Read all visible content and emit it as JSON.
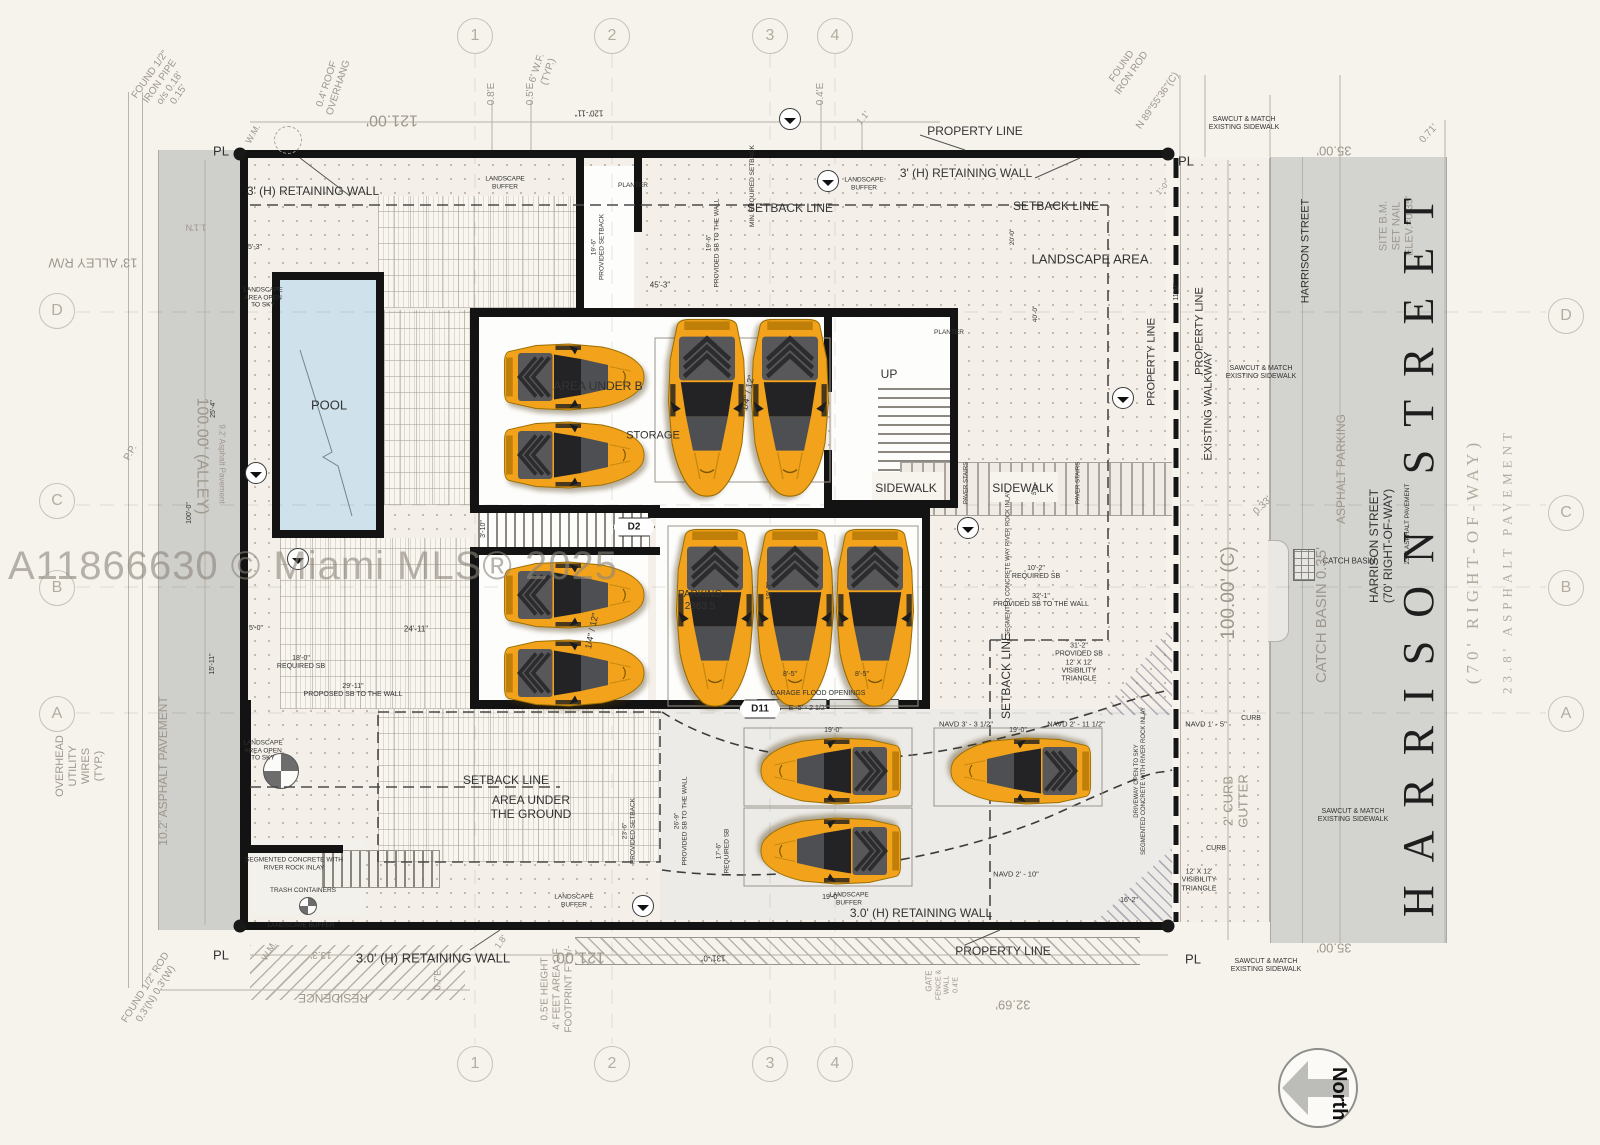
{
  "watermark": "A11866630 © Miami MLS® 2025",
  "compass": {
    "label": "North"
  },
  "grid": {
    "top": [
      "1",
      "2",
      "3",
      "4"
    ],
    "bottom": [
      "1",
      "2",
      "3",
      "4"
    ],
    "left": [
      "D",
      "C",
      "B",
      "A"
    ],
    "right": [
      "D",
      "C",
      "B",
      "A"
    ]
  },
  "tags": {
    "d2": "D2",
    "d11": "D11"
  },
  "cars": {
    "count": 12,
    "body_color": "#f2a31b",
    "accent_color": "#4d4f52"
  },
  "colors": {
    "paper": "#f6f2ec",
    "asphalt": "#d3d3d0",
    "pool_water": "#cfe1ea",
    "wall": "#131313"
  },
  "ann": {
    "found_pipe": "FOUND 1/2\"\nIRON PIPE\no/s 0.18'\n0.15'",
    "wm_tl": "W.M.",
    "roof_ovh": "0.4' ROOF\nOVERHANG",
    "wf_typ": "6' W.F.\n(TYP.)",
    "d121t": "121.00'",
    "d12011": "120'-11\"",
    "e08": "0.8'E",
    "e05": "0.5'E",
    "e04": "0.4'E",
    "d11e": "1.1'",
    "prop_top": "PROPERTY LINE",
    "rod_tr": "FOUND\nIRON ROD",
    "bearing": "N 89°55'36\"(C)",
    "sawcut1": "SAWCUT & MATCH\nEXISTING SIDEWALK",
    "d35t": "35.00'",
    "sitebm": "SITE B.M.\nSET NAIL\nELEV.=0.35'",
    "hsst_top": "HARRISON STREET",
    "d071": "0.71'",
    "pl_tl": "PL",
    "pl_tr": "PL",
    "alley_rw": "13' ALLEY R/W",
    "alley100": "100.00' (ALLEY)",
    "alley_asp": "9.2' Asphalt Pavement",
    "pp": "P.P.",
    "d100ft": "100'-0\"",
    "d1511": "15'-11\"",
    "d254": "25'-4\"",
    "ohw": "OVERHEAD\nUTILITY\nWIRES\n(TYP.)",
    "asp102": "10.2' ASPHALT PAVEMENT",
    "d11n": "1.1'N",
    "d53": "5'-3\"",
    "ret_tl": "3' (H) RETAINING WALL",
    "ret_tr": "3' (H) RETAINING WALL",
    "lb1": "LANDSCAPE\nBUFFER",
    "lb2": "LANDSCAPE\nBUFFER",
    "pltr1": "PLANTER",
    "sbt1": "SETBACK LINE",
    "sbt2": "SETBACK LINE",
    "minreq": "MIN. REQUIRED SETBACK",
    "prov1": "19'-6\"\nPROVIDED SETBACK",
    "prov2": "19'-6\"\nPROVIDED SB TO THE WALL",
    "d453": "45'-3\"",
    "lsarea": "LANDSCAPE AREA",
    "pltr2": "PLANTER",
    "d200": "20'-0\"",
    "d400": "40'-0\"",
    "pl_v1": "PROPERTY LINE",
    "d110": "11'-0\"",
    "d10": "1'-0\"",
    "sawcut2": "SAWCUT & MATCH\nEXISTING SIDEWALK",
    "pl_v2": "PROPERTY LINE",
    "exwalk": "EXISTING WALKWAY",
    "c100": "100.00' (C)",
    "d033": "0.33'",
    "catchb": "CATCH BASIN",
    "catch_big": "CATCH BASIN 0.35'",
    "asparkg": "ASPHALT PARKING",
    "hs_med": "HARRISON STREET\n(70' RIGHT-OF-WAY)",
    "hs_pav_sm": "23.8' ASPHALT PAVEMENT",
    "hs_big": "HARRISON STREET",
    "row70": "(70' RIGHT-OF-WAY)",
    "asp238": "23.8' ASPHALT PAVEMENT",
    "pool": "POOL",
    "lao1": "LANDSCAPE\nAREA OPEN\nTO SKY",
    "lao2": "LANDSCAPE\nAREA OPEN\nTO SKY",
    "aub": "AREA UNDER B",
    "storage": "STORAGE",
    "up": "UP",
    "q12a": "1/4\" / 12\"",
    "q12b": "1/4\" / 12\"",
    "d310": "3'-10\"",
    "parking": "PARKING\n2383.5",
    "d190v": "19'-0\"",
    "swk1": "SIDEWALK",
    "swk2": "SIDEWALK",
    "pvs1": "PAVER STAIRS",
    "pvs2": "PAVER STAIRS",
    "d50v": "5'-0\"",
    "segway": "SEGMENTED CONCRETE WAY RIVER ROCK INLAY",
    "d102": "10'-2\"\nREQUIRED SB",
    "d321": "32'-1\"\nPROVIDED SB TO THE WALL",
    "d312": "31'-2\"\nPROVIDED SB\n12' X 12'\nVISIBILITY\nTRIANGLE",
    "sbv": "SETBACK LINE",
    "d18r": "18'-0\"\nREQUIRED SB",
    "d2911": "29'-11\"\nPROPOSED SB TO THE WALL",
    "d2411": "24'-11\"",
    "d50b": "5'-0\"",
    "sbl": "SETBACK LINE",
    "aug": "AREA UNDER\nTHE GROUND",
    "prov3": "23'-6\"\nPROVIDED SETBACK",
    "prov4": "26'-9\"\nPROVIDED SB TO THE WALL",
    "req2": "17'-6\"\nREQUIRED SB",
    "gfo": "GARAGE FLOOD OPENINGS",
    "d85a": "8'-5\"",
    "d85b": "8'-5\"",
    "d11txt": "E -5' - 2 1/2\"",
    "navd1": "NAVD 3' - 3 1/2\"",
    "navd2": "NAVD 2' - 11 1/2\"",
    "navd3": "NAVD 2' - 10\"",
    "navd4": "NAVD 1' - 5\"",
    "d190a": "19'-0\"",
    "d190b": "19'-0\"",
    "d190c": "19'-0\"",
    "d162": "16'-2\"",
    "drvnote": "DRIVEWAY OPEN TO SKY\nSEGMENTED CONCRETE WITH RIVER ROCK INLAY",
    "vis2": "12' X 12'\nVISIBILITY\nTRIANGLE",
    "curb1": "CURB",
    "curb2": "CURB",
    "curbgut": "2' CURB\nGUTTER",
    "lb3": "LANDSCAPE\nBUFFER",
    "lb4": "LANDSCAPE\nBUFFER",
    "lb5": "LANDSCAPE BUFFER",
    "retb1": "3.0' (H) RETAINING WALL",
    "retb2": "3.0' (H) RETAINING WALL",
    "seg2": "SEGMENTED CONCRETE WITH\nRIVER ROCK INLAY",
    "trash": "TRASH CONTAINERS",
    "prop_bot": "PROPERTY LINE",
    "d121b": "121.00'",
    "d131": "131'-0\"",
    "d3269": "32.69'",
    "pl_bl": "PL",
    "pl_br": "PL",
    "wm_bl": "W.M.",
    "d133": "13.3'",
    "d18": "1.8'",
    "d07e": "0.7'E",
    "residence": "RESIDENCE",
    "rod_bl": "FOUND 1/2\" ROD\n0.3'(N) 0.3'(W)",
    "hnote": "0.5'E HEIGHT\n4' FEET AREA OF\nFOOTPRINT FT +/-",
    "gate": "GATE",
    "fence": "FENCE &\nWALL\n0.4'E",
    "sawcut3": "SAWCUT & MATCH\nEXISTING SIDEWALK",
    "sawcut4": "SAWCUT & MATCH\nEXISTING SIDEWALK",
    "d35b": "35.00'"
  }
}
